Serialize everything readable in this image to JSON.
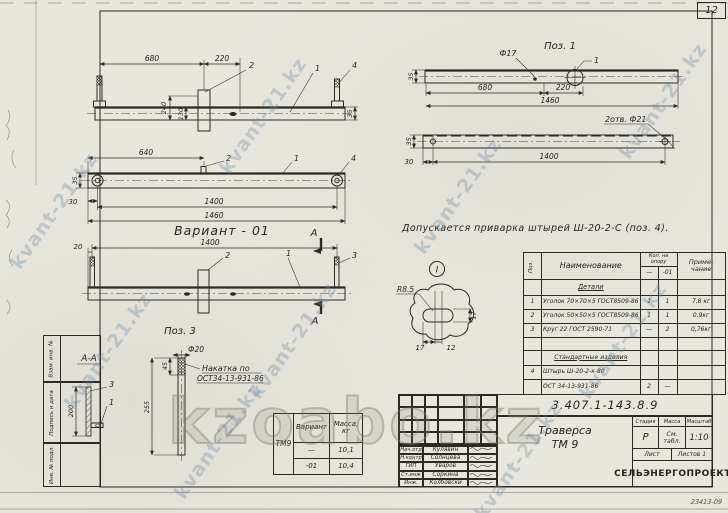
{
  "sheet": {
    "page_number": "12",
    "footer_code": "23413-09",
    "doc_number": "3.407.1-143.8.9"
  },
  "watermarks": {
    "diagonal": "kvant-21.kz",
    "big": "kzoabo.kz"
  },
  "margin_stamps": {
    "stamp1": "Взам. инв. №",
    "stamp2": "Подпись и дата",
    "stamp3": "Инв. № подл."
  },
  "labels": {
    "variant": "Вариант - 01",
    "pos1": "Поз. 1",
    "pos3": "Поз. 3",
    "section": "А-А",
    "section_mark": "А",
    "detail_mark": "I",
    "weld_note": "Допускается приварка штырей Ш-20-2-С (поз. 4).",
    "knurl_note_1": "Накатка по",
    "knurl_note_2": "ОСТ34-13-931-86",
    "holes_note": "2отв. Ф21",
    "dia17": "Ф17",
    "dia20": "Ф20",
    "radius": "R8.5"
  },
  "dims": {
    "12": "12",
    "17": "17",
    "20": "20",
    "30": "30",
    "35": "35",
    "45": "45",
    "130": "130",
    "200": "200",
    "220": "220",
    "240": "240",
    "255": "255",
    "640": "640",
    "680": "680",
    "1400": "1400",
    "1460": "1460"
  },
  "callouts": {
    "c1": "1",
    "c2": "2",
    "c3": "3",
    "c4": "4"
  },
  "parts_table": {
    "col_pos": "Поз.",
    "col_name": "Наименование",
    "col_qty": "Кол. на опору",
    "col_qty_sub1": "—",
    "col_qty_sub2": "-01",
    "col_note_1": "Приме-",
    "col_note_2": "чание",
    "section_details": "Детали",
    "section_standard": "Стандартные изделия",
    "rows": [
      {
        "pos": "1",
        "name": "Уголок 70×70×5 ГОСТ8509-86",
        "q1": "1",
        "q2": "1",
        "note": "7,8 кг"
      },
      {
        "pos": "2",
        "name": "Уголок 50×50×5 ГОСТ8509-86",
        "q1": "1",
        "q2": "1",
        "note": "0,9кг"
      },
      {
        "pos": "3",
        "name": "Круг 22 ГОСТ 2590-71",
        "q1": "—",
        "q2": "2",
        "note": "0,76кг"
      },
      {
        "pos": "4",
        "name": "Штырь Ш-20-2-к-80",
        "q1": "",
        "q2": "",
        "note": ""
      },
      {
        "pos": "",
        "name": "ОСТ 34-13-931-86",
        "q1": "2",
        "q2": "—",
        "note": ""
      }
    ]
  },
  "mass_table": {
    "product": "ТМ9",
    "col_variant": "Вариант",
    "col_mass_1": "Масса,",
    "col_mass_2": "кг",
    "rows": [
      {
        "variant": "—",
        "mass": "10,1"
      },
      {
        "variant": "-01",
        "mass": "10,4"
      }
    ]
  },
  "title_block": {
    "product_1": "Траверса",
    "product_2": "ТМ 9",
    "col_stage": "Стадия",
    "col_mass": "Масса",
    "col_scale": "Масштаб",
    "stage": "Р",
    "mass_1": "См.",
    "mass_2": "табл.",
    "scale": "1:10",
    "sheet_label": "Лист",
    "sheets_label": "Листов 1",
    "organization": "СЕЛЬЭНЕРГОПРОЕКТ",
    "signatures": [
      {
        "role": "Нач.отд",
        "name": "Кулявин"
      },
      {
        "role": "Н.контр",
        "name": "Солнцева"
      },
      {
        "role": "ГИП",
        "name": "Уваров"
      },
      {
        "role": "Ст.инж",
        "name": "Соркина"
      },
      {
        "role": "Инж.",
        "name": "Колбовски"
      }
    ]
  }
}
